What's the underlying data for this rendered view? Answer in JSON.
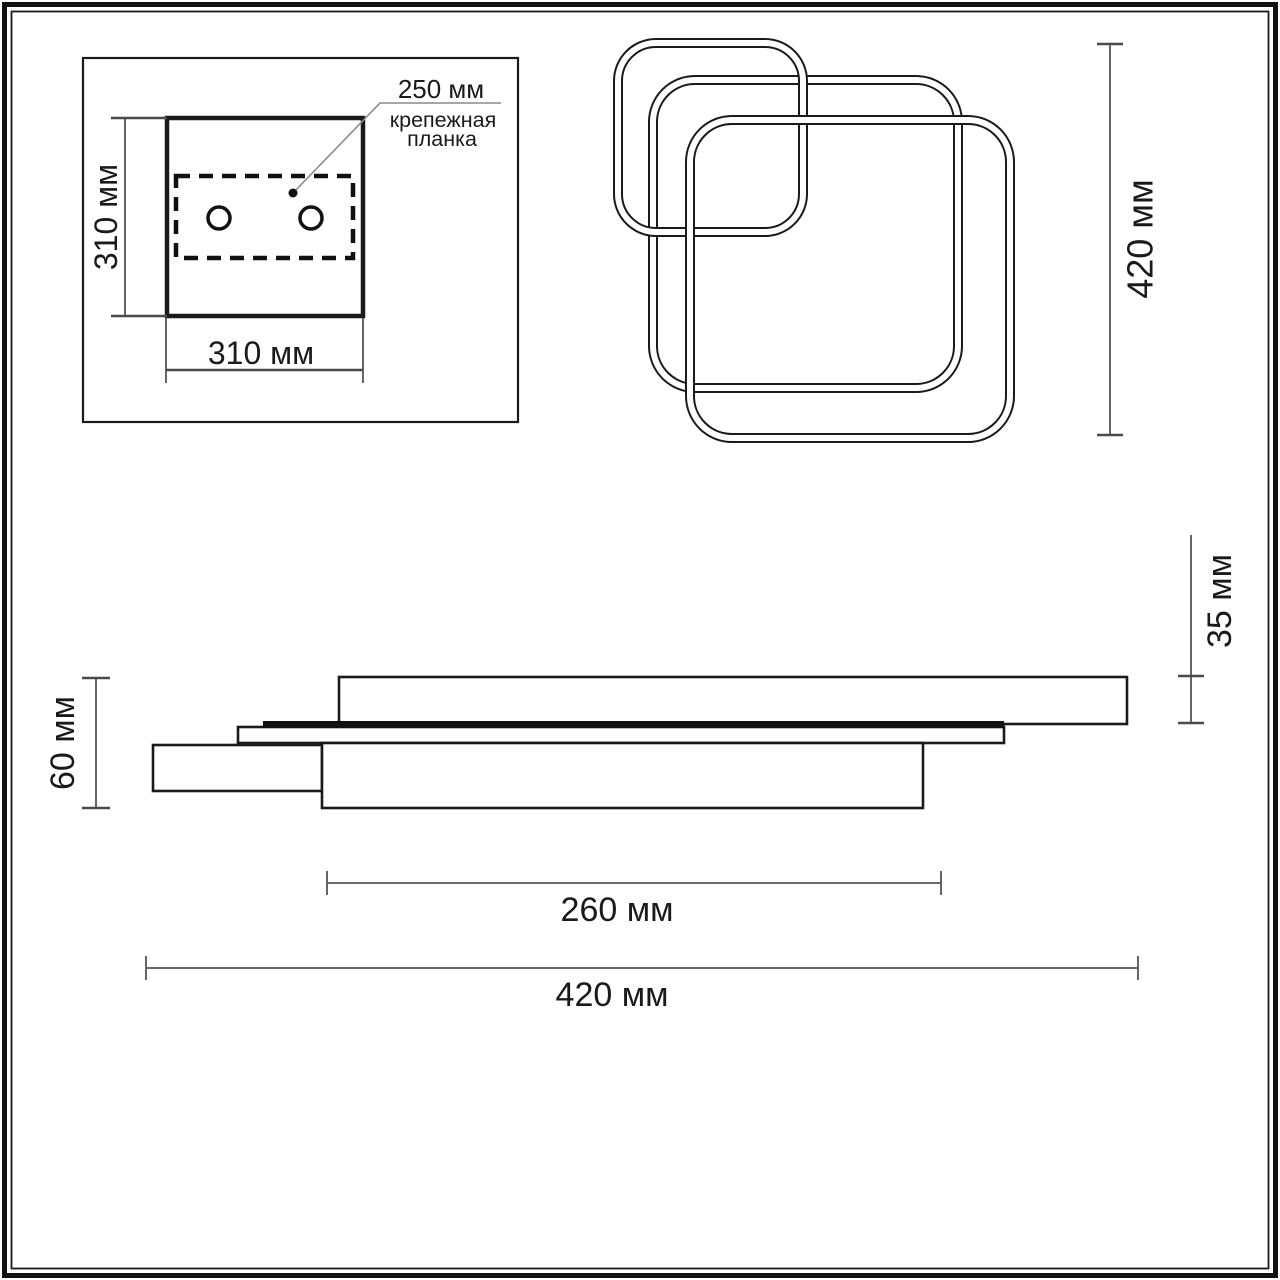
{
  "page": {
    "background": "#ffffff",
    "ink_color": "#1a1a1a",
    "dim_line_color": "#555555"
  },
  "inset": {
    "callout_value": "250 мм",
    "callout_label_line1": "крепежная",
    "callout_label_line2": "планка",
    "height_label": "310 мм",
    "width_label": "310 мм"
  },
  "top_view": {
    "height_label": "420 мм"
  },
  "side_view": {
    "thickness_label": "35 мм",
    "height_label": "60 мм",
    "inner_width_label": "260 мм",
    "width_label": "420 мм"
  },
  "dimensions_mm": {
    "mounting_plate_width": 250,
    "canopy_width": 310,
    "canopy_height": 310,
    "fixture_height": 420,
    "top_plate_thickness": 35,
    "overall_depth": 60,
    "bottom_plate_width": 260,
    "overall_width": 420
  }
}
